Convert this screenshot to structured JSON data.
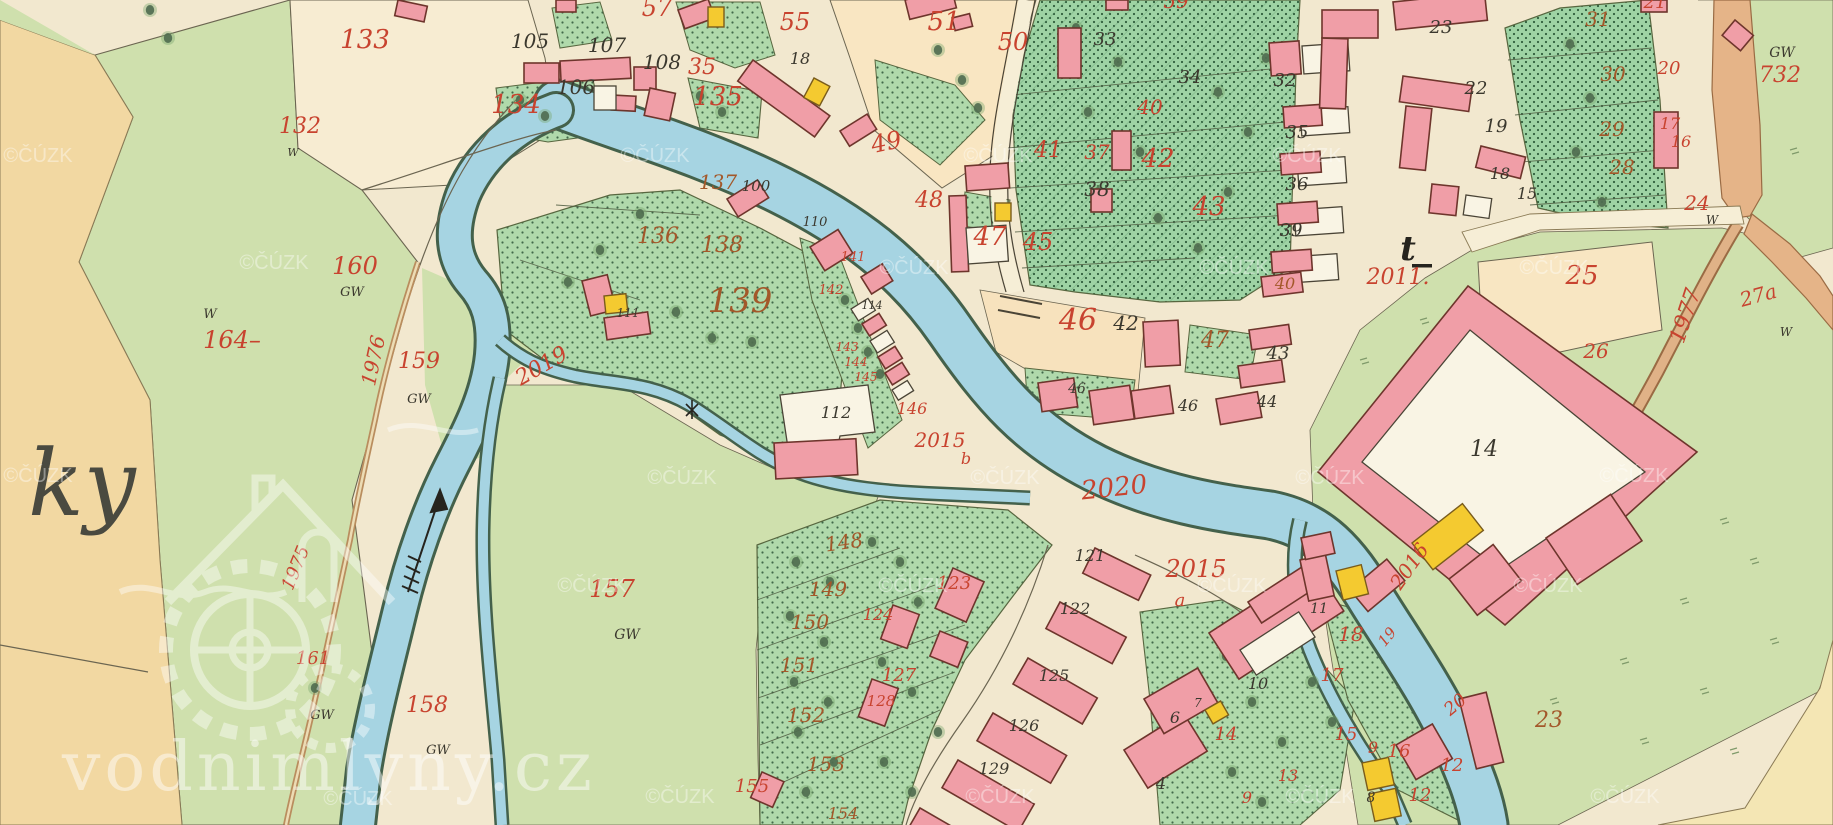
{
  "map": {
    "kind": "historical-cadastral-map",
    "watermark": {
      "site_text": "vodnimlyny.cz",
      "copyright_text": "©ČÚZK",
      "copyright_positions": [
        [
          38,
          162
        ],
        [
          655,
          162
        ],
        [
          998,
          162
        ],
        [
          1307,
          162
        ],
        [
          274,
          269
        ],
        [
          914,
          274
        ],
        [
          1234,
          274
        ],
        [
          1554,
          274
        ],
        [
          38,
          482
        ],
        [
          682,
          484
        ],
        [
          1005,
          484
        ],
        [
          1330,
          484
        ],
        [
          1634,
          482
        ],
        [
          592,
          592
        ],
        [
          913,
          592
        ],
        [
          1232,
          592
        ],
        [
          1548,
          592
        ],
        [
          358,
          805
        ],
        [
          680,
          803
        ],
        [
          1000,
          803
        ],
        [
          1320,
          803
        ],
        [
          1625,
          803
        ]
      ]
    },
    "place_script_text": "ky",
    "colors": {
      "paper": "#f2e8cf",
      "meadow": "#cfe0ad",
      "orchard": "#b0d9ab",
      "tan_field": "#f2d8a2",
      "peach_field": "#f9e6c2",
      "water": "#a6d4e2",
      "building_masonry": "#f09ea7",
      "building_wood": "#f4ca30",
      "road": "#e5b488",
      "label_red": "#c8432f",
      "label_brown": "#a3582a",
      "ink": "#3b382e"
    },
    "labels": [
      {
        "t": "133",
        "x": 365,
        "y": 48,
        "s": 26,
        "c": "red"
      },
      {
        "t": "132",
        "x": 300,
        "y": 133,
        "s": 22,
        "c": "red"
      },
      {
        "t": "57",
        "x": 657,
        "y": 16,
        "s": 24,
        "c": "red"
      },
      {
        "t": "55",
        "x": 795,
        "y": 30,
        "s": 24,
        "c": "red"
      },
      {
        "t": "35",
        "x": 702,
        "y": 74,
        "s": 22,
        "c": "red"
      },
      {
        "t": "134",
        "x": 516,
        "y": 113,
        "s": 26,
        "c": "red"
      },
      {
        "t": "135",
        "x": 718,
        "y": 105,
        "s": 26,
        "c": "red"
      },
      {
        "t": "51",
        "x": 944,
        "y": 30,
        "s": 26,
        "c": "red"
      },
      {
        "t": "50",
        "x": 1013,
        "y": 50,
        "s": 24,
        "c": "red"
      },
      {
        "t": "59",
        "x": 1176,
        "y": 8,
        "s": 20,
        "c": "red"
      },
      {
        "t": "49",
        "x": 888,
        "y": 150,
        "s": 24,
        "c": "red",
        "r": -12
      },
      {
        "t": "48",
        "x": 929,
        "y": 207,
        "s": 22,
        "c": "red"
      },
      {
        "t": "41",
        "x": 1048,
        "y": 157,
        "s": 22,
        "c": "red"
      },
      {
        "t": "37",
        "x": 1097,
        "y": 159,
        "s": 20,
        "c": "red"
      },
      {
        "t": "42",
        "x": 1158,
        "y": 167,
        "s": 26,
        "c": "red"
      },
      {
        "t": "43",
        "x": 1209,
        "y": 215,
        "s": 26,
        "c": "red"
      },
      {
        "t": "40",
        "x": 1150,
        "y": 114,
        "s": 20,
        "c": "red"
      },
      {
        "t": "45",
        "x": 1038,
        "y": 250,
        "s": 24,
        "c": "red"
      },
      {
        "t": "46",
        "x": 1078,
        "y": 330,
        "s": 30,
        "c": "red"
      },
      {
        "t": "47",
        "x": 990,
        "y": 245,
        "s": 26,
        "c": "red"
      },
      {
        "t": "2011.",
        "x": 1398,
        "y": 284,
        "s": 22,
        "c": "red"
      },
      {
        "t": "25",
        "x": 1582,
        "y": 284,
        "s": 26,
        "c": "red"
      },
      {
        "t": "26",
        "x": 1596,
        "y": 358,
        "s": 20,
        "c": "red"
      },
      {
        "t": "24",
        "x": 1697,
        "y": 210,
        "s": 20,
        "c": "red"
      },
      {
        "t": "27a",
        "x": 1760,
        "y": 302,
        "s": 20,
        "c": "red",
        "r": -15
      },
      {
        "t": "1977",
        "x": 1692,
        "y": 318,
        "s": 22,
        "c": "red",
        "r": -72
      },
      {
        "t": "732",
        "x": 1780,
        "y": 82,
        "s": 22,
        "c": "red"
      },
      {
        "t": "21",
        "x": 1655,
        "y": 8,
        "s": 18,
        "c": "red"
      },
      {
        "t": "20",
        "x": 1669,
        "y": 74,
        "s": 18,
        "c": "red"
      },
      {
        "t": "17",
        "x": 1670,
        "y": 129,
        "s": 16,
        "c": "red"
      },
      {
        "t": "16",
        "x": 1681,
        "y": 147,
        "s": 16,
        "c": "red"
      },
      {
        "t": "160",
        "x": 355,
        "y": 274,
        "s": 24,
        "c": "red"
      },
      {
        "t": "164–",
        "x": 232,
        "y": 348,
        "s": 24,
        "c": "red"
      },
      {
        "t": "159",
        "x": 419,
        "y": 368,
        "s": 22,
        "c": "red"
      },
      {
        "t": "1976",
        "x": 380,
        "y": 362,
        "s": 20,
        "c": "red",
        "r": -78
      },
      {
        "t": "1975",
        "x": 301,
        "y": 570,
        "s": 18,
        "c": "red",
        "r": -68
      },
      {
        "t": "161",
        "x": 313,
        "y": 664,
        "s": 18,
        "c": "red"
      },
      {
        "t": "158",
        "x": 427,
        "y": 712,
        "s": 22,
        "c": "red"
      },
      {
        "t": "157",
        "x": 612,
        "y": 597,
        "s": 24,
        "c": "red"
      },
      {
        "t": "2019",
        "x": 545,
        "y": 372,
        "s": 22,
        "c": "red",
        "r": -30
      },
      {
        "t": "2015",
        "x": 940,
        "y": 447,
        "s": 20,
        "c": "red"
      },
      {
        "t": "b",
        "x": 966,
        "y": 464,
        "s": 16,
        "c": "red"
      },
      {
        "t": "2020",
        "x": 1115,
        "y": 496,
        "s": 26,
        "c": "red",
        "r": -6
      },
      {
        "t": "2015",
        "x": 1196,
        "y": 577,
        "s": 24,
        "c": "red"
      },
      {
        "t": "a",
        "x": 1180,
        "y": 606,
        "s": 18,
        "c": "red"
      },
      {
        "t": "2016",
        "x": 1415,
        "y": 570,
        "s": 20,
        "c": "red",
        "r": -55
      },
      {
        "t": "123",
        "x": 954,
        "y": 589,
        "s": 18,
        "c": "red"
      },
      {
        "t": "124",
        "x": 878,
        "y": 620,
        "s": 16,
        "c": "red"
      },
      {
        "t": "127",
        "x": 899,
        "y": 681,
        "s": 18,
        "c": "red"
      },
      {
        "t": "128",
        "x": 881,
        "y": 706,
        "s": 15,
        "c": "red"
      },
      {
        "t": "155",
        "x": 752,
        "y": 792,
        "s": 18,
        "c": "red"
      },
      {
        "t": "141",
        "x": 853,
        "y": 261,
        "s": 13,
        "c": "red"
      },
      {
        "t": "142",
        "x": 831,
        "y": 294,
        "s": 13,
        "c": "red"
      },
      {
        "t": "143",
        "x": 847,
        "y": 351,
        "s": 12,
        "c": "red"
      },
      {
        "t": "144",
        "x": 856,
        "y": 366,
        "s": 12,
        "c": "red"
      },
      {
        "t": "145",
        "x": 866,
        "y": 381,
        "s": 12,
        "c": "red"
      },
      {
        "t": "146",
        "x": 912,
        "y": 414,
        "s": 16,
        "c": "red"
      },
      {
        "t": "18",
        "x": 1351,
        "y": 641,
        "s": 20,
        "c": "red"
      },
      {
        "t": "17",
        "x": 1332,
        "y": 681,
        "s": 18,
        "c": "red"
      },
      {
        "t": "19",
        "x": 1391,
        "y": 640,
        "s": 15,
        "c": "red",
        "r": -50
      },
      {
        "t": "20",
        "x": 1459,
        "y": 709,
        "s": 18,
        "c": "red",
        "r": -40
      },
      {
        "t": "15",
        "x": 1346,
        "y": 740,
        "s": 18,
        "c": "red"
      },
      {
        "t": "9",
        "x": 1373,
        "y": 753,
        "s": 16,
        "c": "red"
      },
      {
        "t": "16",
        "x": 1399,
        "y": 757,
        "s": 18,
        "c": "red"
      },
      {
        "t": "12",
        "x": 1452,
        "y": 771,
        "s": 18,
        "c": "red"
      },
      {
        "t": "12",
        "x": 1420,
        "y": 801,
        "s": 18,
        "c": "red"
      },
      {
        "t": "14",
        "x": 1226,
        "y": 740,
        "s": 18,
        "c": "red"
      },
      {
        "t": "13",
        "x": 1288,
        "y": 781,
        "s": 16,
        "c": "red"
      },
      {
        "t": "9",
        "x": 1247,
        "y": 803,
        "s": 16,
        "c": "red"
      },
      {
        "t": "136",
        "x": 658,
        "y": 243,
        "s": 22,
        "c": "brn"
      },
      {
        "t": "137",
        "x": 718,
        "y": 189,
        "s": 20,
        "c": "brn"
      },
      {
        "t": "138",
        "x": 722,
        "y": 252,
        "s": 22,
        "c": "brn"
      },
      {
        "t": "139",
        "x": 740,
        "y": 312,
        "s": 34,
        "c": "brn"
      },
      {
        "t": "148",
        "x": 845,
        "y": 549,
        "s": 20,
        "c": "brn",
        "r": -8
      },
      {
        "t": "149",
        "x": 828,
        "y": 596,
        "s": 20,
        "c": "brn"
      },
      {
        "t": "150",
        "x": 810,
        "y": 629,
        "s": 20,
        "c": "brn"
      },
      {
        "t": "151",
        "x": 799,
        "y": 672,
        "s": 20,
        "c": "brn"
      },
      {
        "t": "152",
        "x": 806,
        "y": 722,
        "s": 20,
        "c": "brn"
      },
      {
        "t": "153",
        "x": 826,
        "y": 771,
        "s": 20,
        "c": "brn"
      },
      {
        "t": "154",
        "x": 843,
        "y": 819,
        "s": 16,
        "c": "brn"
      },
      {
        "t": "31",
        "x": 1598,
        "y": 26,
        "s": 20,
        "c": "brn"
      },
      {
        "t": "30",
        "x": 1613,
        "y": 81,
        "s": 20,
        "c": "brn"
      },
      {
        "t": "29",
        "x": 1612,
        "y": 136,
        "s": 20,
        "c": "brn"
      },
      {
        "t": "28",
        "x": 1622,
        "y": 174,
        "s": 20,
        "c": "brn"
      },
      {
        "t": "23",
        "x": 1549,
        "y": 727,
        "s": 22,
        "c": "brn"
      },
      {
        "t": "47",
        "x": 1215,
        "y": 347,
        "s": 22,
        "c": "brn"
      },
      {
        "t": "40",
        "x": 1285,
        "y": 289,
        "s": 16,
        "c": "brn"
      },
      {
        "t": "105",
        "x": 530,
        "y": 48,
        "s": 20,
        "c": "blk"
      },
      {
        "t": "107",
        "x": 607,
        "y": 52,
        "s": 20,
        "c": "blk"
      },
      {
        "t": "108",
        "x": 662,
        "y": 69,
        "s": 20,
        "c": "blk"
      },
      {
        "t": "106",
        "x": 576,
        "y": 94,
        "s": 20,
        "c": "blk"
      },
      {
        "t": "18",
        "x": 800,
        "y": 64,
        "s": 16,
        "c": "blk"
      },
      {
        "t": "100",
        "x": 756,
        "y": 191,
        "s": 15,
        "c": "blk"
      },
      {
        "t": "110",
        "x": 815,
        "y": 226,
        "s": 13,
        "c": "blk"
      },
      {
        "t": "114",
        "x": 872,
        "y": 309,
        "s": 11,
        "c": "blk"
      },
      {
        "t": "111",
        "x": 628,
        "y": 317,
        "s": 12,
        "c": "blk"
      },
      {
        "t": "112",
        "x": 836,
        "y": 418,
        "s": 16,
        "c": "blk"
      },
      {
        "t": "33",
        "x": 1105,
        "y": 45,
        "s": 18,
        "c": "blk"
      },
      {
        "t": "34",
        "x": 1190,
        "y": 83,
        "s": 18,
        "c": "blk"
      },
      {
        "t": "38",
        "x": 1097,
        "y": 196,
        "s": 20,
        "c": "blk"
      },
      {
        "t": "32",
        "x": 1285,
        "y": 86,
        "s": 18,
        "c": "blk"
      },
      {
        "t": "35",
        "x": 1297,
        "y": 138,
        "s": 18,
        "c": "blk"
      },
      {
        "t": "36",
        "x": 1297,
        "y": 190,
        "s": 18,
        "c": "blk"
      },
      {
        "t": "39",
        "x": 1291,
        "y": 236,
        "s": 18,
        "c": "blk"
      },
      {
        "t": "42",
        "x": 1126,
        "y": 330,
        "s": 20,
        "c": "blk"
      },
      {
        "t": "43",
        "x": 1278,
        "y": 359,
        "s": 18,
        "c": "blk"
      },
      {
        "t": "44",
        "x": 1267,
        "y": 407,
        "s": 16,
        "c": "blk"
      },
      {
        "t": "46",
        "x": 1077,
        "y": 393,
        "s": 14,
        "c": "blk"
      },
      {
        "t": "46",
        "x": 1188,
        "y": 411,
        "s": 16,
        "c": "blk"
      },
      {
        "t": "23",
        "x": 1441,
        "y": 33,
        "s": 18,
        "c": "blk"
      },
      {
        "t": "22",
        "x": 1476,
        "y": 94,
        "s": 18,
        "c": "blk"
      },
      {
        "t": "19",
        "x": 1496,
        "y": 132,
        "s": 18,
        "c": "blk"
      },
      {
        "t": "18",
        "x": 1500,
        "y": 179,
        "s": 16,
        "c": "blk"
      },
      {
        "t": "15",
        "x": 1527,
        "y": 199,
        "s": 16,
        "c": "blk"
      },
      {
        "t": "14",
        "x": 1484,
        "y": 456,
        "s": 22,
        "c": "blk"
      },
      {
        "t": "121",
        "x": 1090,
        "y": 561,
        "s": 16,
        "c": "blk"
      },
      {
        "t": "122",
        "x": 1075,
        "y": 614,
        "s": 16,
        "c": "blk"
      },
      {
        "t": "125",
        "x": 1054,
        "y": 681,
        "s": 16,
        "c": "blk"
      },
      {
        "t": "126",
        "x": 1024,
        "y": 731,
        "s": 16,
        "c": "blk"
      },
      {
        "t": "129",
        "x": 994,
        "y": 774,
        "s": 16,
        "c": "blk"
      },
      {
        "t": "10",
        "x": 1258,
        "y": 689,
        "s": 16,
        "c": "blk"
      },
      {
        "t": "11",
        "x": 1319,
        "y": 613,
        "s": 14,
        "c": "blk"
      },
      {
        "t": "6",
        "x": 1175,
        "y": 723,
        "s": 16,
        "c": "blk"
      },
      {
        "t": "7",
        "x": 1198,
        "y": 707,
        "s": 12,
        "c": "blk"
      },
      {
        "t": "4",
        "x": 1161,
        "y": 789,
        "s": 16,
        "c": "blk"
      },
      {
        "t": "8",
        "x": 1371,
        "y": 802,
        "s": 14,
        "c": "blk"
      },
      {
        "t": "GW",
        "x": 352,
        "y": 296,
        "s": 13,
        "c": "blk"
      },
      {
        "t": "GW",
        "x": 419,
        "y": 403,
        "s": 13,
        "c": "blk"
      },
      {
        "t": "GW",
        "x": 322,
        "y": 719,
        "s": 13,
        "c": "blk"
      },
      {
        "t": "GW",
        "x": 438,
        "y": 754,
        "s": 13,
        "c": "blk"
      },
      {
        "t": "GW",
        "x": 627,
        "y": 639,
        "s": 14,
        "c": "blk"
      },
      {
        "t": "GW",
        "x": 1782,
        "y": 57,
        "s": 14,
        "c": "blk"
      },
      {
        "t": "W",
        "x": 210,
        "y": 318,
        "s": 13,
        "c": "blk"
      },
      {
        "t": "W",
        "x": 293,
        "y": 156,
        "s": 11,
        "c": "blk"
      },
      {
        "t": "W",
        "x": 1712,
        "y": 224,
        "s": 12,
        "c": "blk"
      },
      {
        "t": "W",
        "x": 1786,
        "y": 336,
        "s": 12,
        "c": "blk"
      },
      {
        "t": "t",
        "x": 1408,
        "y": 260,
        "s": 34,
        "c": "tsym"
      },
      {
        "t": "ky",
        "x": 28,
        "y": 515,
        "s": 92,
        "c": "scr"
      }
    ]
  }
}
